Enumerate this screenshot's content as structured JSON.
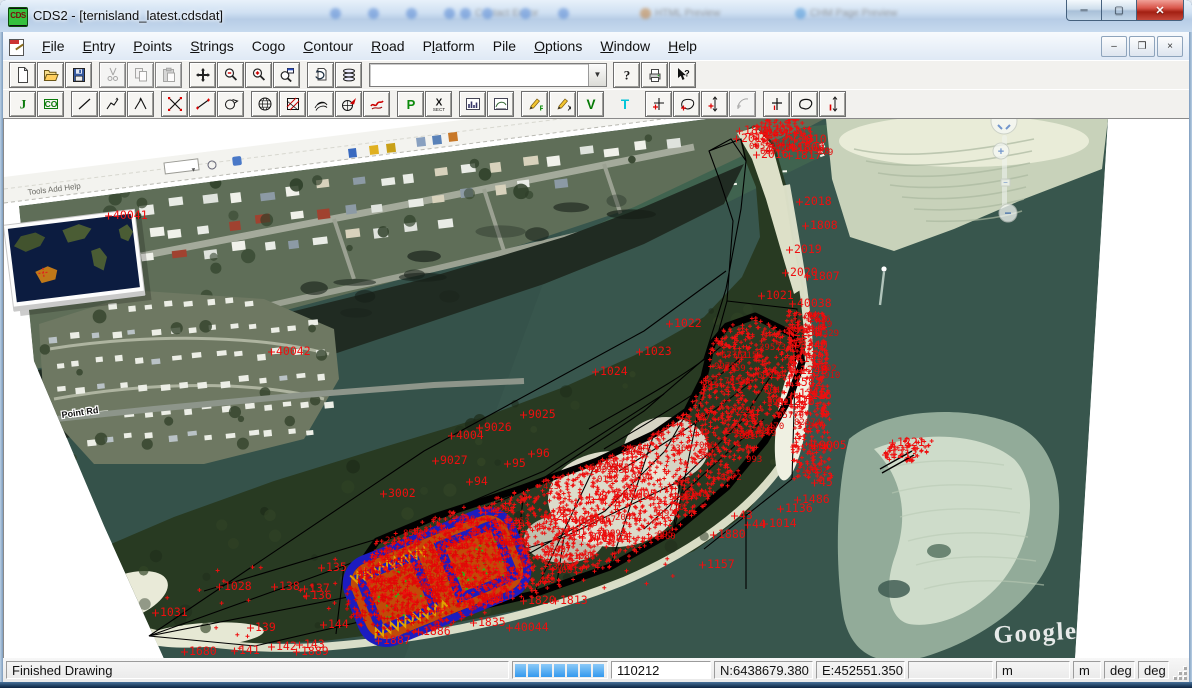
{
  "window": {
    "title": "CDS2 - [ternisland_latest.cdsdat]",
    "app_icon_text": "CDS",
    "buttons": {
      "minimize": "─",
      "maximize": "▢",
      "close": "✕"
    },
    "ghost_items": [
      "Contact Editor",
      "HTML Preview",
      "CHM Page Preview"
    ]
  },
  "menubar": {
    "items": [
      {
        "label": "File",
        "u": 0
      },
      {
        "label": "Entry",
        "u": 0
      },
      {
        "label": "Points",
        "u": 0
      },
      {
        "label": "Strings",
        "u": 0
      },
      {
        "label": "Cogo",
        "u": 2
      },
      {
        "label": "Contour",
        "u": 0
      },
      {
        "label": "Road",
        "u": 0
      },
      {
        "label": "Platform",
        "u": 1
      },
      {
        "label": "Pile",
        "u": -1
      },
      {
        "label": "Options",
        "u": 0
      },
      {
        "label": "Window",
        "u": 0
      },
      {
        "label": "Help",
        "u": 0
      }
    ],
    "mdi_buttons": {
      "minimize": "–",
      "restore": "❐",
      "close": "×"
    }
  },
  "toolbar_main": {
    "groups": [
      [
        {
          "icon": "new"
        },
        {
          "icon": "open"
        },
        {
          "icon": "save"
        }
      ],
      [
        {
          "icon": "cut",
          "disabled": true
        },
        {
          "icon": "copy",
          "disabled": true
        },
        {
          "icon": "paste",
          "disabled": true
        }
      ],
      [
        {
          "icon": "pan"
        },
        {
          "icon": "zoom-out"
        },
        {
          "icon": "zoom-in"
        },
        {
          "icon": "zoom-window"
        }
      ],
      [
        {
          "icon": "redraw"
        },
        {
          "icon": "layers"
        }
      ]
    ],
    "combo": {
      "value": "",
      "placeholder": ""
    },
    "groups_right": [
      [
        {
          "icon": "help"
        },
        {
          "icon": "print"
        },
        {
          "icon": "context-help"
        }
      ]
    ]
  },
  "toolbar_cad": {
    "groups": [
      [
        {
          "icon": "join-j"
        },
        {
          "icon": "cogo-co"
        }
      ],
      [
        {
          "icon": "line"
        },
        {
          "icon": "polyline"
        },
        {
          "icon": "xline"
        }
      ],
      [
        {
          "icon": "scatter-x"
        },
        {
          "icon": "tape"
        },
        {
          "icon": "circle-arrow"
        }
      ],
      [
        {
          "icon": "globe"
        },
        {
          "icon": "hatch"
        },
        {
          "icon": "contours"
        },
        {
          "icon": "globe-arrow"
        },
        {
          "icon": "freehand"
        }
      ],
      [
        {
          "icon": "p-green"
        },
        {
          "icon": "x-sect"
        }
      ],
      [
        {
          "icon": "chart"
        },
        {
          "icon": "section"
        }
      ],
      [
        {
          "icon": "edit-p"
        },
        {
          "icon": "edit-x"
        },
        {
          "icon": "v-green"
        }
      ],
      [
        {
          "icon": "t-cyan",
          "flat": true
        }
      ],
      [
        {
          "icon": "pt-cross"
        },
        {
          "icon": "pt-balloon"
        },
        {
          "icon": "pt-vert"
        },
        {
          "icon": "pt-arc",
          "disabled": true
        }
      ],
      [
        {
          "icon": "cross2"
        },
        {
          "icon": "poly2"
        },
        {
          "icon": "vert2"
        }
      ]
    ]
  },
  "statusbar": {
    "message": "Finished Drawing",
    "progress_segments": 7,
    "point_id": "110212",
    "north": "N:6438679.380",
    "east": "E:452551.350",
    "blank": "",
    "units": [
      "m",
      "m",
      "deg",
      "deg"
    ],
    "progress_color": "#3399ee"
  },
  "canvas": {
    "watermark": "Google",
    "watermark_tm": "™",
    "road_label": "Point Rd",
    "ge_menu_text": "Tools   Add   Help",
    "colors": {
      "water": "#35524a",
      "land_dark": "#283a22",
      "beach": "#e3e6cf",
      "survey_red": "#ee0f0f",
      "survey_blue": "#1c1cc0",
      "hatch_orange": "#c24a08",
      "outline_black": "#000000"
    },
    "labels": [
      [
        109,
        88,
        "40041"
      ],
      [
        272,
        224,
        "40042"
      ],
      [
        740,
        3,
        "1814"
      ],
      [
        768,
        3,
        "2011"
      ],
      [
        737,
        11,
        "2015"
      ],
      [
        795,
        12,
        "1810"
      ],
      [
        793,
        20,
        "1809"
      ],
      [
        757,
        27,
        "2016"
      ],
      [
        790,
        28,
        "1817"
      ],
      [
        800,
        74,
        "2018"
      ],
      [
        806,
        98,
        "1808"
      ],
      [
        790,
        122,
        "2019"
      ],
      [
        786,
        145,
        "2020"
      ],
      [
        808,
        149,
        "1807"
      ],
      [
        762,
        168,
        "1021"
      ],
      [
        793,
        176,
        "40038"
      ],
      [
        790,
        205,
        "2236"
      ],
      [
        796,
        218,
        "3340"
      ],
      [
        792,
        231,
        "4145"
      ],
      [
        796,
        243,
        "1248"
      ],
      [
        790,
        255,
        "1582"
      ],
      [
        800,
        268,
        "2116"
      ],
      [
        795,
        266,
        "1215"
      ],
      [
        783,
        274,
        "1216"
      ],
      [
        815,
        318,
        "9005"
      ],
      [
        670,
        196,
        "1022"
      ],
      [
        640,
        224,
        "1023"
      ],
      [
        596,
        244,
        "1024"
      ],
      [
        524,
        287,
        "9025"
      ],
      [
        452,
        308,
        "4004"
      ],
      [
        480,
        300,
        "9026"
      ],
      [
        436,
        333,
        "9027"
      ],
      [
        532,
        326,
        "96"
      ],
      [
        508,
        336,
        "95"
      ],
      [
        470,
        354,
        "94"
      ],
      [
        384,
        366,
        "3002"
      ],
      [
        590,
        369,
        "58"
      ],
      [
        618,
        367,
        "60005"
      ],
      [
        545,
        389,
        "62"
      ],
      [
        567,
        393,
        "40036"
      ],
      [
        598,
        411,
        "1004"
      ],
      [
        583,
        410,
        "1005"
      ],
      [
        815,
        355,
        "45"
      ],
      [
        798,
        372,
        "1486"
      ],
      [
        781,
        381,
        "1136"
      ],
      [
        735,
        388,
        "43"
      ],
      [
        748,
        397,
        "44"
      ],
      [
        714,
        407,
        "1880"
      ],
      [
        703,
        437,
        "1157"
      ],
      [
        220,
        459,
        "1028"
      ],
      [
        156,
        485,
        "1031"
      ],
      [
        322,
        440,
        "135"
      ],
      [
        305,
        461,
        "137"
      ],
      [
        307,
        468,
        "136"
      ],
      [
        275,
        459,
        "138"
      ],
      [
        251,
        500,
        "139"
      ],
      [
        235,
        523,
        "141"
      ],
      [
        272,
        519,
        "142"
      ],
      [
        300,
        517,
        "143"
      ],
      [
        324,
        497,
        "144"
      ],
      [
        185,
        524,
        "1680"
      ],
      [
        297,
        524,
        "1889"
      ],
      [
        379,
        513,
        "1887"
      ],
      [
        419,
        504,
        "1886"
      ],
      [
        474,
        495,
        "1835"
      ],
      [
        510,
        500,
        "40044"
      ],
      [
        524,
        473,
        "1820"
      ],
      [
        556,
        473,
        "1813"
      ],
      [
        765,
        396,
        "1014"
      ],
      [
        893,
        315,
        "1221"
      ],
      [
        886,
        327,
        "1213"
      ]
    ],
    "cloud": {
      "main": 2300,
      "blue": 650,
      "band": 380,
      "spit": 130,
      "jetty": 60,
      "beach": 55,
      "noise_labels_main": 95,
      "noise_labels_band": 14,
      "noise_labels_spit": 8
    },
    "nav_control": {
      "plus": "+",
      "minus": "−"
    }
  }
}
